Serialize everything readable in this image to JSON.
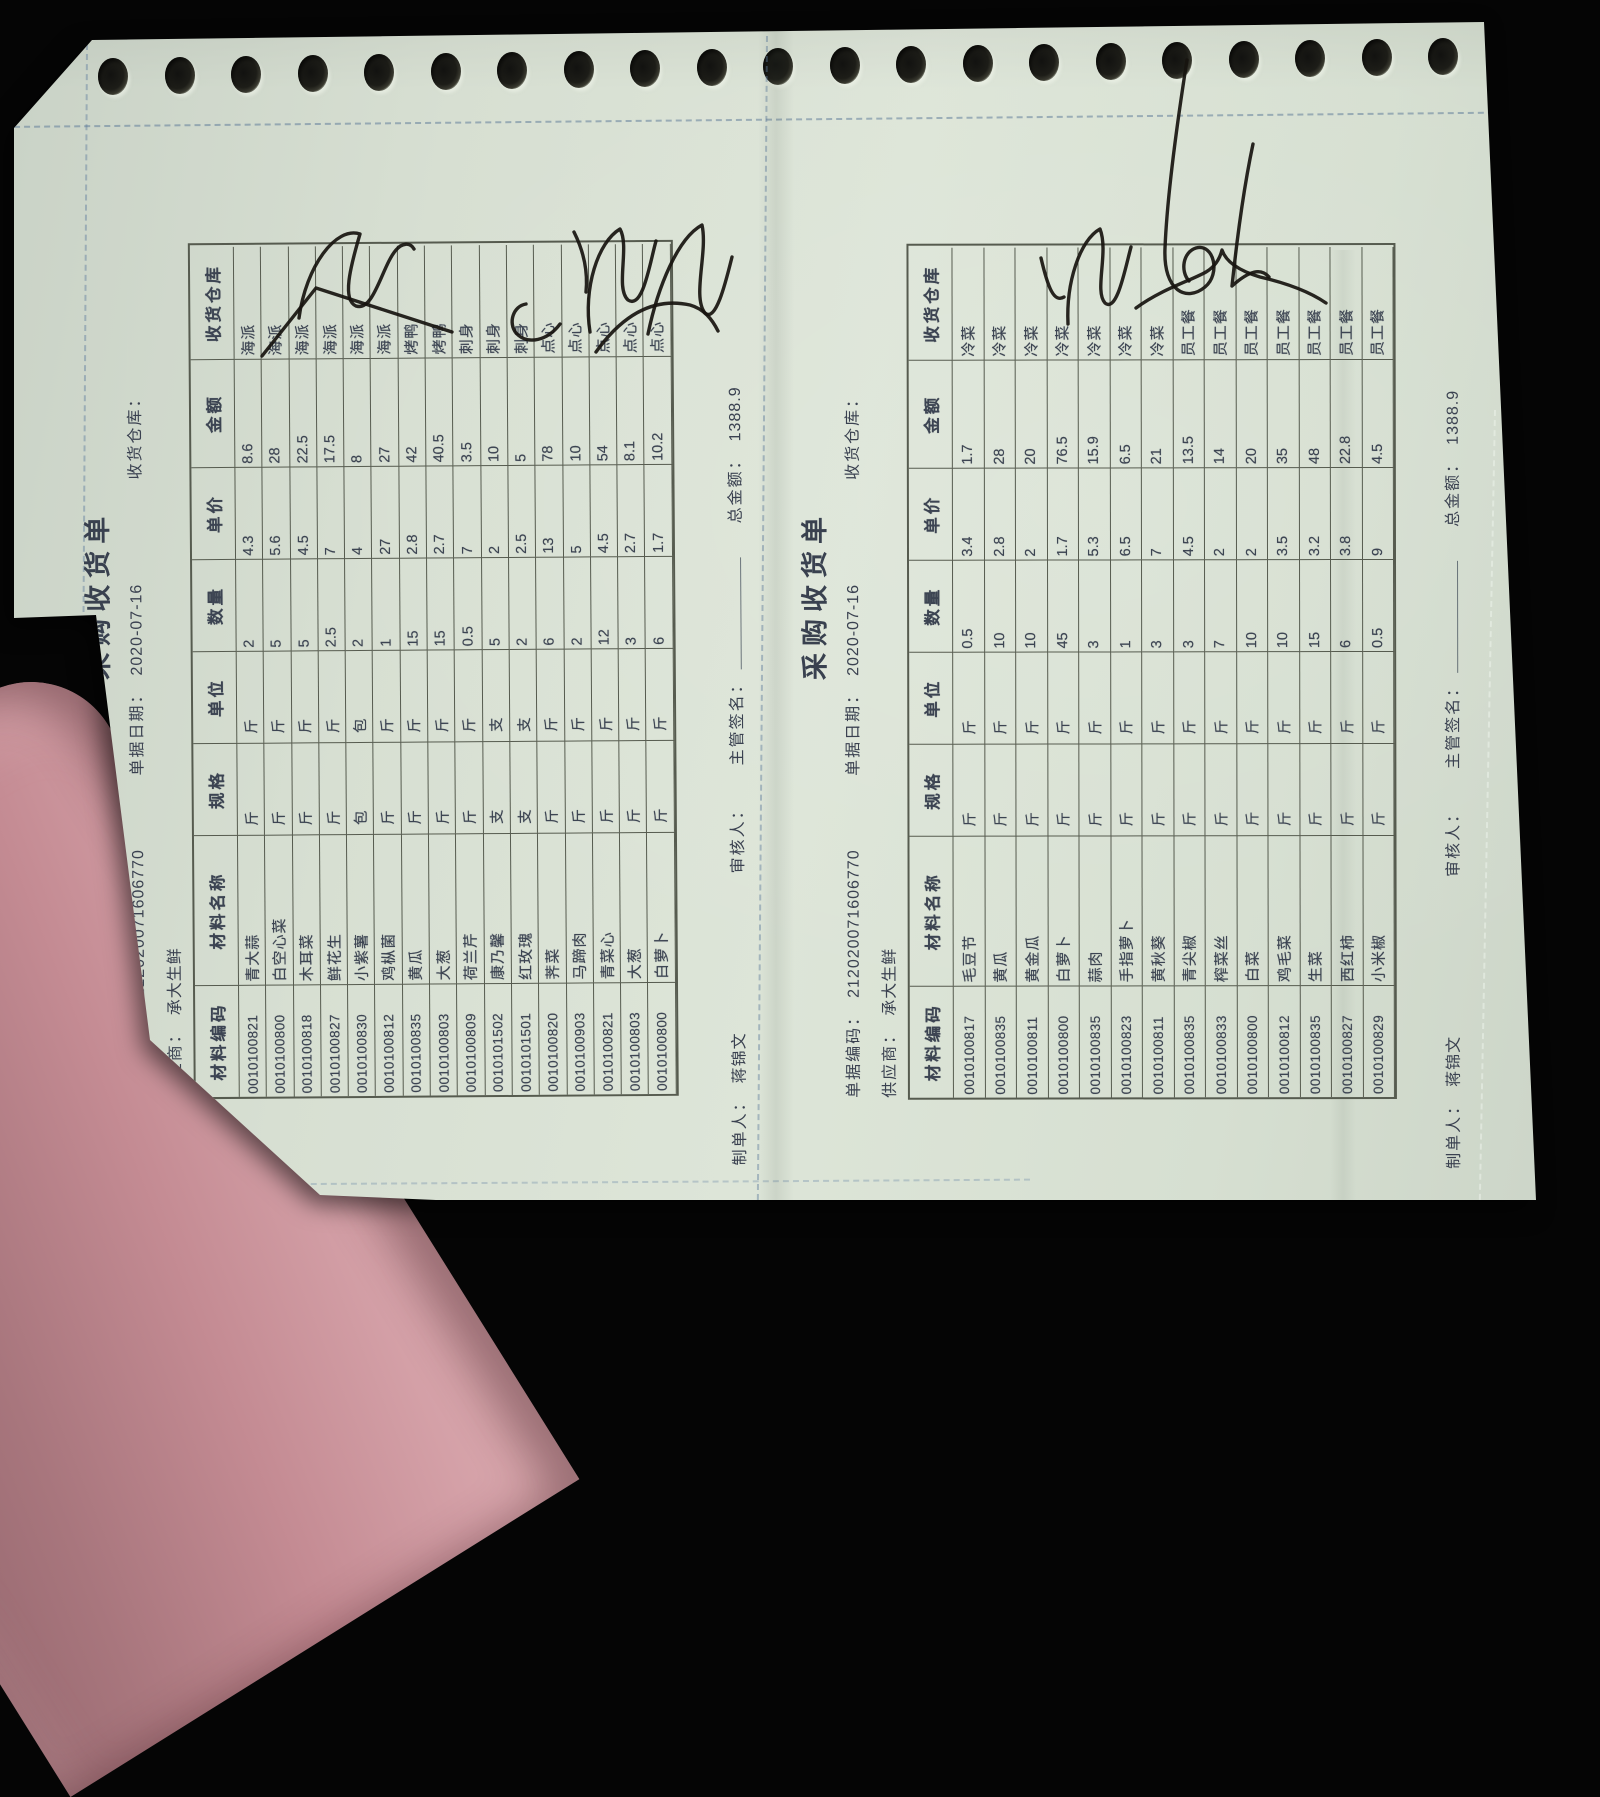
{
  "doc_left": {
    "title": "采购收货单",
    "fields": {
      "code_label": "单据编码：",
      "code": "212020071606770",
      "date_label": "单据日期：",
      "date": "2020-07-16",
      "warehouse_label": "收货仓库：",
      "supplier_label": "供应商：",
      "supplier": "承大生鲜"
    },
    "columns": [
      "材料编码",
      "材料名称",
      "规格",
      "单位",
      "数量",
      "单价",
      "金额",
      "收货仓库"
    ],
    "rows": [
      [
        "0010100821",
        "青大蒜",
        "斤",
        "斤",
        "2",
        "4.3",
        "8.6",
        "海派"
      ],
      [
        "0010100800",
        "白空心菜",
        "斤",
        "斤",
        "5",
        "5.6",
        "28",
        "海派"
      ],
      [
        "0010100818",
        "木耳菜",
        "斤",
        "斤",
        "5",
        "4.5",
        "22.5",
        "海派"
      ],
      [
        "0010100827",
        "鲜花生",
        "斤",
        "斤",
        "2.5",
        "7",
        "17.5",
        "海派"
      ],
      [
        "0010100830",
        "小紫薯",
        "包",
        "包",
        "2",
        "4",
        "8",
        "海派"
      ],
      [
        "0010100812",
        "鸡枞菌",
        "斤",
        "斤",
        "1",
        "27",
        "27",
        "海派"
      ],
      [
        "0010100835",
        "黄瓜",
        "斤",
        "斤",
        "15",
        "2.8",
        "42",
        "烤鸭"
      ],
      [
        "0010100803",
        "大葱",
        "斤",
        "斤",
        "15",
        "2.7",
        "40.5",
        "烤鸭"
      ],
      [
        "0010100809",
        "荷兰芹",
        "斤",
        "斤",
        "0.5",
        "7",
        "3.5",
        "刺身"
      ],
      [
        "0010101502",
        "康乃馨",
        "支",
        "支",
        "5",
        "2",
        "10",
        "刺身"
      ],
      [
        "0010101501",
        "红玫瑰",
        "支",
        "支",
        "2",
        "2.5",
        "5",
        "刺身"
      ],
      [
        "0010100820",
        "荠菜",
        "斤",
        "斤",
        "6",
        "13",
        "78",
        "点心"
      ],
      [
        "0010100903",
        "马蹄肉",
        "斤",
        "斤",
        "2",
        "5",
        "10",
        "点心"
      ],
      [
        "0010100821",
        "青菜心",
        "斤",
        "斤",
        "12",
        "4.5",
        "54",
        "点心"
      ],
      [
        "0010100803",
        "大葱",
        "斤",
        "斤",
        "3",
        "2.7",
        "8.1",
        "点心"
      ],
      [
        "0010100800",
        "白萝卜",
        "斤",
        "斤",
        "6",
        "1.7",
        "10.2",
        "点心"
      ]
    ],
    "footer": {
      "preparer_label": "制单人：",
      "preparer": "蒋锦文",
      "reviewer_label": "审核人：",
      "manager_label": "主管签名：",
      "total_label": "总金额：",
      "total": "1388.9"
    }
  },
  "doc_right": {
    "title": "采购收货单",
    "fields": {
      "code_label": "单据编码：",
      "code": "212020071606770",
      "date_label": "单据日期：",
      "date": "2020-07-16",
      "warehouse_label": "收货仓库：",
      "supplier_label": "供应商：",
      "supplier": "承大生鲜"
    },
    "columns": [
      "材料编码",
      "材料名称",
      "规格",
      "单位",
      "数量",
      "单价",
      "金额",
      "收货仓库"
    ],
    "rows": [
      [
        "0010100817",
        "毛豆节",
        "斤",
        "斤",
        "0.5",
        "3.4",
        "1.7",
        "冷菜"
      ],
      [
        "0010100835",
        "黄瓜",
        "斤",
        "斤",
        "10",
        "2.8",
        "28",
        "冷菜"
      ],
      [
        "0010100811",
        "黄金瓜",
        "斤",
        "斤",
        "10",
        "2",
        "20",
        "冷菜"
      ],
      [
        "0010100800",
        "白萝卜",
        "斤",
        "斤",
        "45",
        "1.7",
        "76.5",
        "冷菜"
      ],
      [
        "0010100835",
        "蒜肉",
        "斤",
        "斤",
        "3",
        "5.3",
        "15.9",
        "冷菜"
      ],
      [
        "0010100823",
        "手指萝卜",
        "斤",
        "斤",
        "1",
        "6.5",
        "6.5",
        "冷菜"
      ],
      [
        "0010100811",
        "黄秋葵",
        "斤",
        "斤",
        "3",
        "7",
        "21",
        "冷菜"
      ],
      [
        "0010100835",
        "青尖椒",
        "斤",
        "斤",
        "3",
        "4.5",
        "13.5",
        "员工餐"
      ],
      [
        "0010100833",
        "榨菜丝",
        "斤",
        "斤",
        "7",
        "2",
        "14",
        "员工餐"
      ],
      [
        "0010100800",
        "白菜",
        "斤",
        "斤",
        "10",
        "2",
        "20",
        "员工餐"
      ],
      [
        "0010100812",
        "鸡毛菜",
        "斤",
        "斤",
        "10",
        "3.5",
        "35",
        "员工餐"
      ],
      [
        "0010100835",
        "生菜",
        "斤",
        "斤",
        "15",
        "3.2",
        "48",
        "员工餐"
      ],
      [
        "0010100827",
        "西红柿",
        "斤",
        "斤",
        "6",
        "3.8",
        "22.8",
        "员工餐"
      ],
      [
        "0010100829",
        "小米椒",
        "斤",
        "斤",
        "0.5",
        "9",
        "4.5",
        "员工餐"
      ]
    ],
    "footer": {
      "preparer_label": "制单人：",
      "preparer": "蒋锦文",
      "reviewer_label": "审核人：",
      "manager_label": "主管签名：",
      "total_label": "总金额：",
      "total": "1388.9"
    }
  }
}
